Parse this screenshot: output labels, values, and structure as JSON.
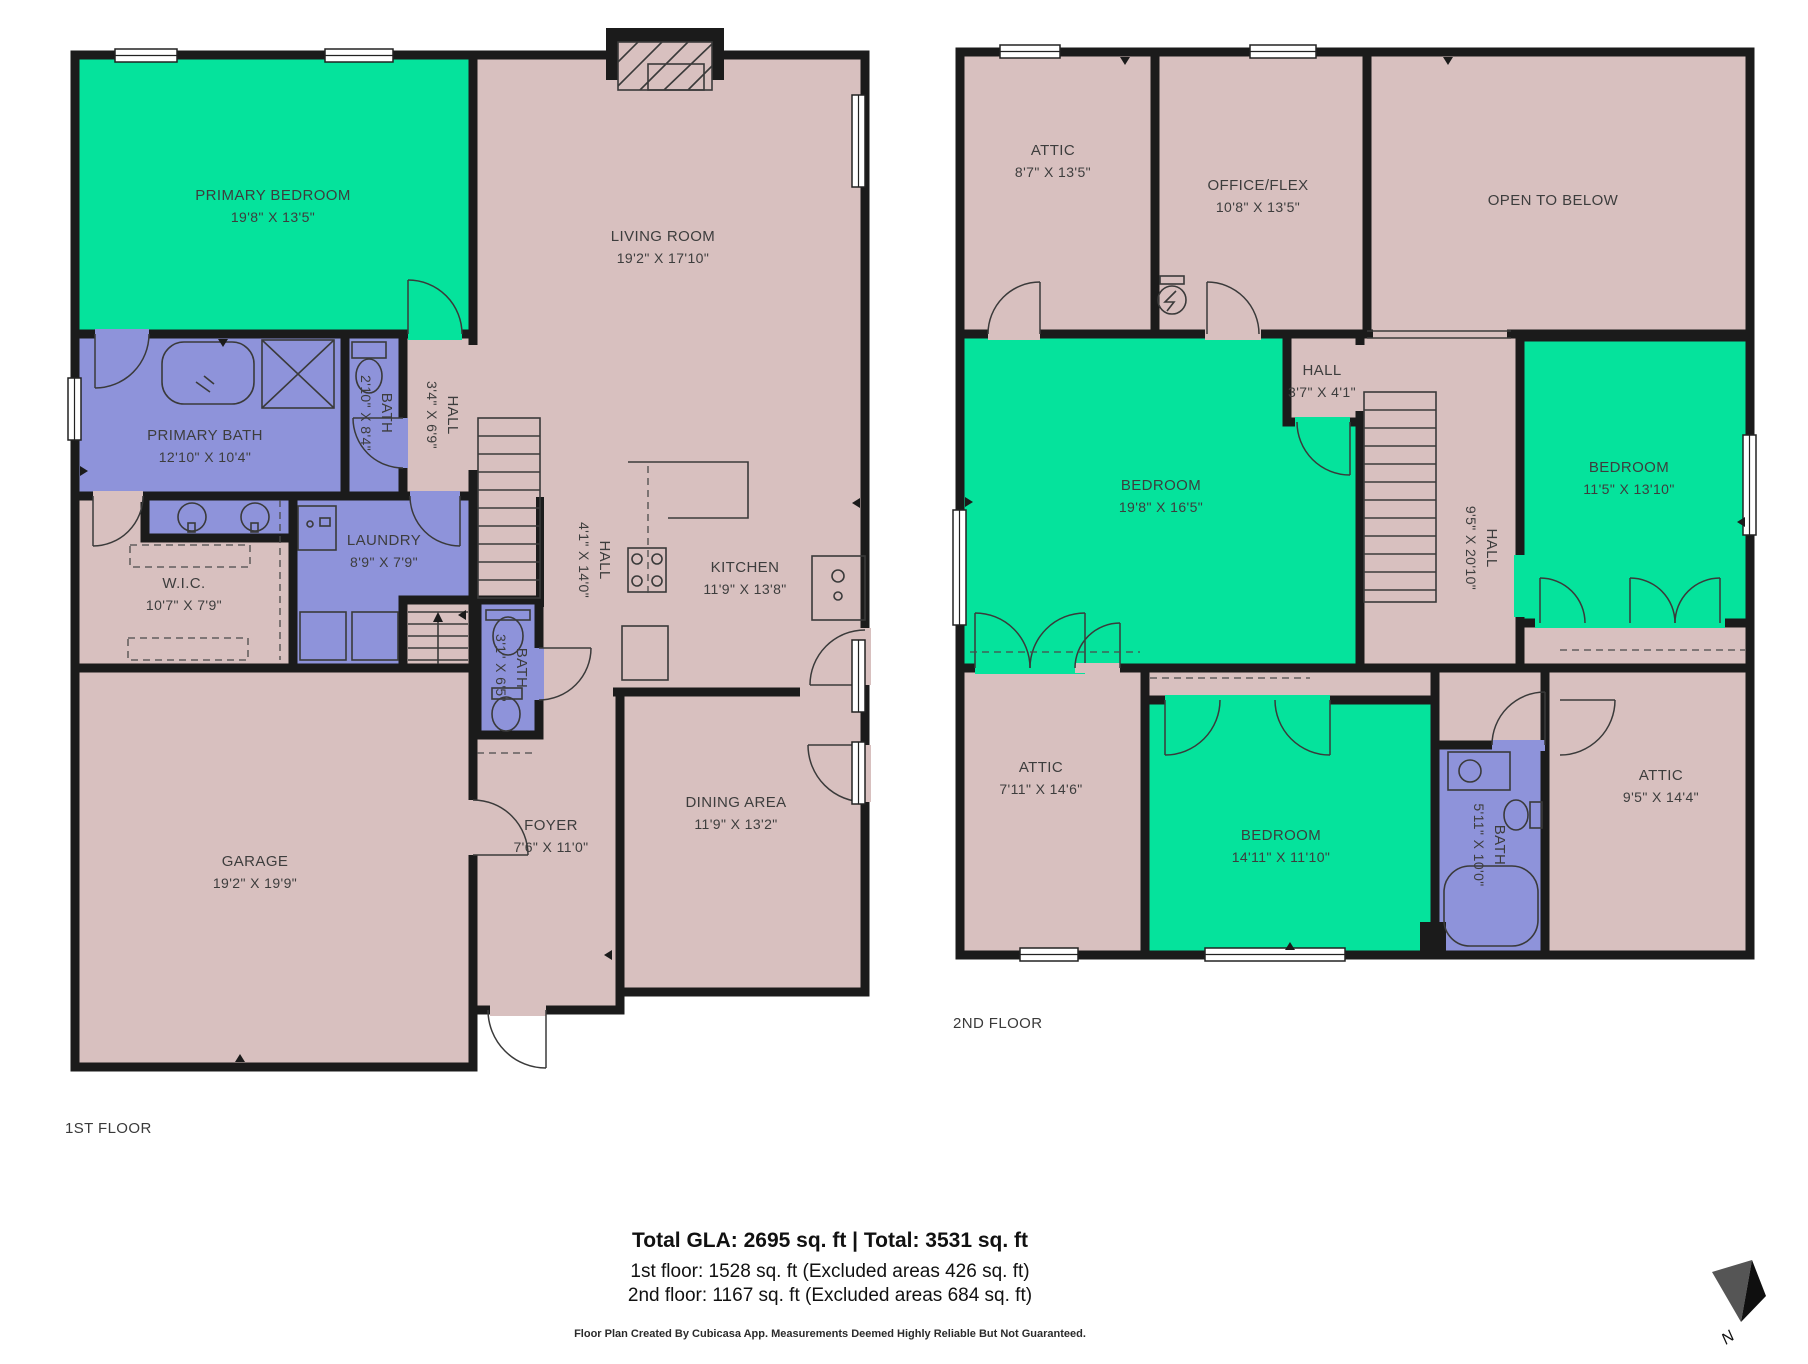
{
  "colors": {
    "background": "#ffffff",
    "wall": "#1b1b1b",
    "room_default": "#d8c0bf",
    "room_highlight": "#05e39c",
    "room_wet": "#8e93da",
    "label": "#3d3d3d"
  },
  "floor1": {
    "label": "1ST FLOOR",
    "rooms": [
      {
        "name": "PRIMARY BEDROOM",
        "dims": "19'8\" X 13'5\""
      },
      {
        "name": "LIVING ROOM",
        "dims": "19'2\" X 17'10\""
      },
      {
        "name": "PRIMARY BATH",
        "dims": "12'10\" X 10'4\""
      },
      {
        "name": "BATH",
        "dims": "2'10\" X 8'4\""
      },
      {
        "name": "HALL",
        "dims": "3'4\" X 6'9\""
      },
      {
        "name": "W.I.C.",
        "dims": "10'7\" X 7'9\""
      },
      {
        "name": "LAUNDRY",
        "dims": "8'9\" X 7'9\""
      },
      {
        "name": "HALL",
        "dims": "4'1\" X 14'0\""
      },
      {
        "name": "KITCHEN",
        "dims": "11'9\" X 13'8\""
      },
      {
        "name": "BATH",
        "dims": "3'1\" X 6'5\""
      },
      {
        "name": "FOYER",
        "dims": "7'6\" X 11'0\""
      },
      {
        "name": "DINING AREA",
        "dims": "11'9\" X 13'2\""
      },
      {
        "name": "GARAGE",
        "dims": "19'2\" X 19'9\""
      }
    ]
  },
  "floor2": {
    "label": "2ND FLOOR",
    "rooms": [
      {
        "name": "ATTIC",
        "dims": "8'7\" X 13'5\""
      },
      {
        "name": "OFFICE/FLEX",
        "dims": "10'8\" X 13'5\""
      },
      {
        "name": "OPEN TO BELOW",
        "dims": ""
      },
      {
        "name": "HALL",
        "dims": "3'7\" X 4'1\""
      },
      {
        "name": "BEDROOM",
        "dims": "19'8\" X 16'5\""
      },
      {
        "name": "BEDROOM",
        "dims": "11'5\" X 13'10\""
      },
      {
        "name": "HALL",
        "dims": "9'5\" X 20'10\""
      },
      {
        "name": "ATTIC",
        "dims": "7'11\" X 14'6\""
      },
      {
        "name": "BEDROOM",
        "dims": "14'11\" X 11'10\""
      },
      {
        "name": "BATH",
        "dims": "5'11\" X 10'0\""
      },
      {
        "name": "ATTIC",
        "dims": "9'5\" X 14'4\""
      }
    ]
  },
  "footer": {
    "totals": "Total GLA: 2695 sq. ft | Total: 3531 sq. ft",
    "floor1_area": "1st floor: 1528 sq. ft (Excluded areas 426 sq. ft)",
    "floor2_area": "2nd floor: 1167 sq. ft (Excluded areas 684 sq. ft)",
    "disclaimer": "Floor Plan Created By Cubicasa App. Measurements Deemed Highly Reliable But Not Guaranteed."
  },
  "compass": {
    "label": "N"
  }
}
